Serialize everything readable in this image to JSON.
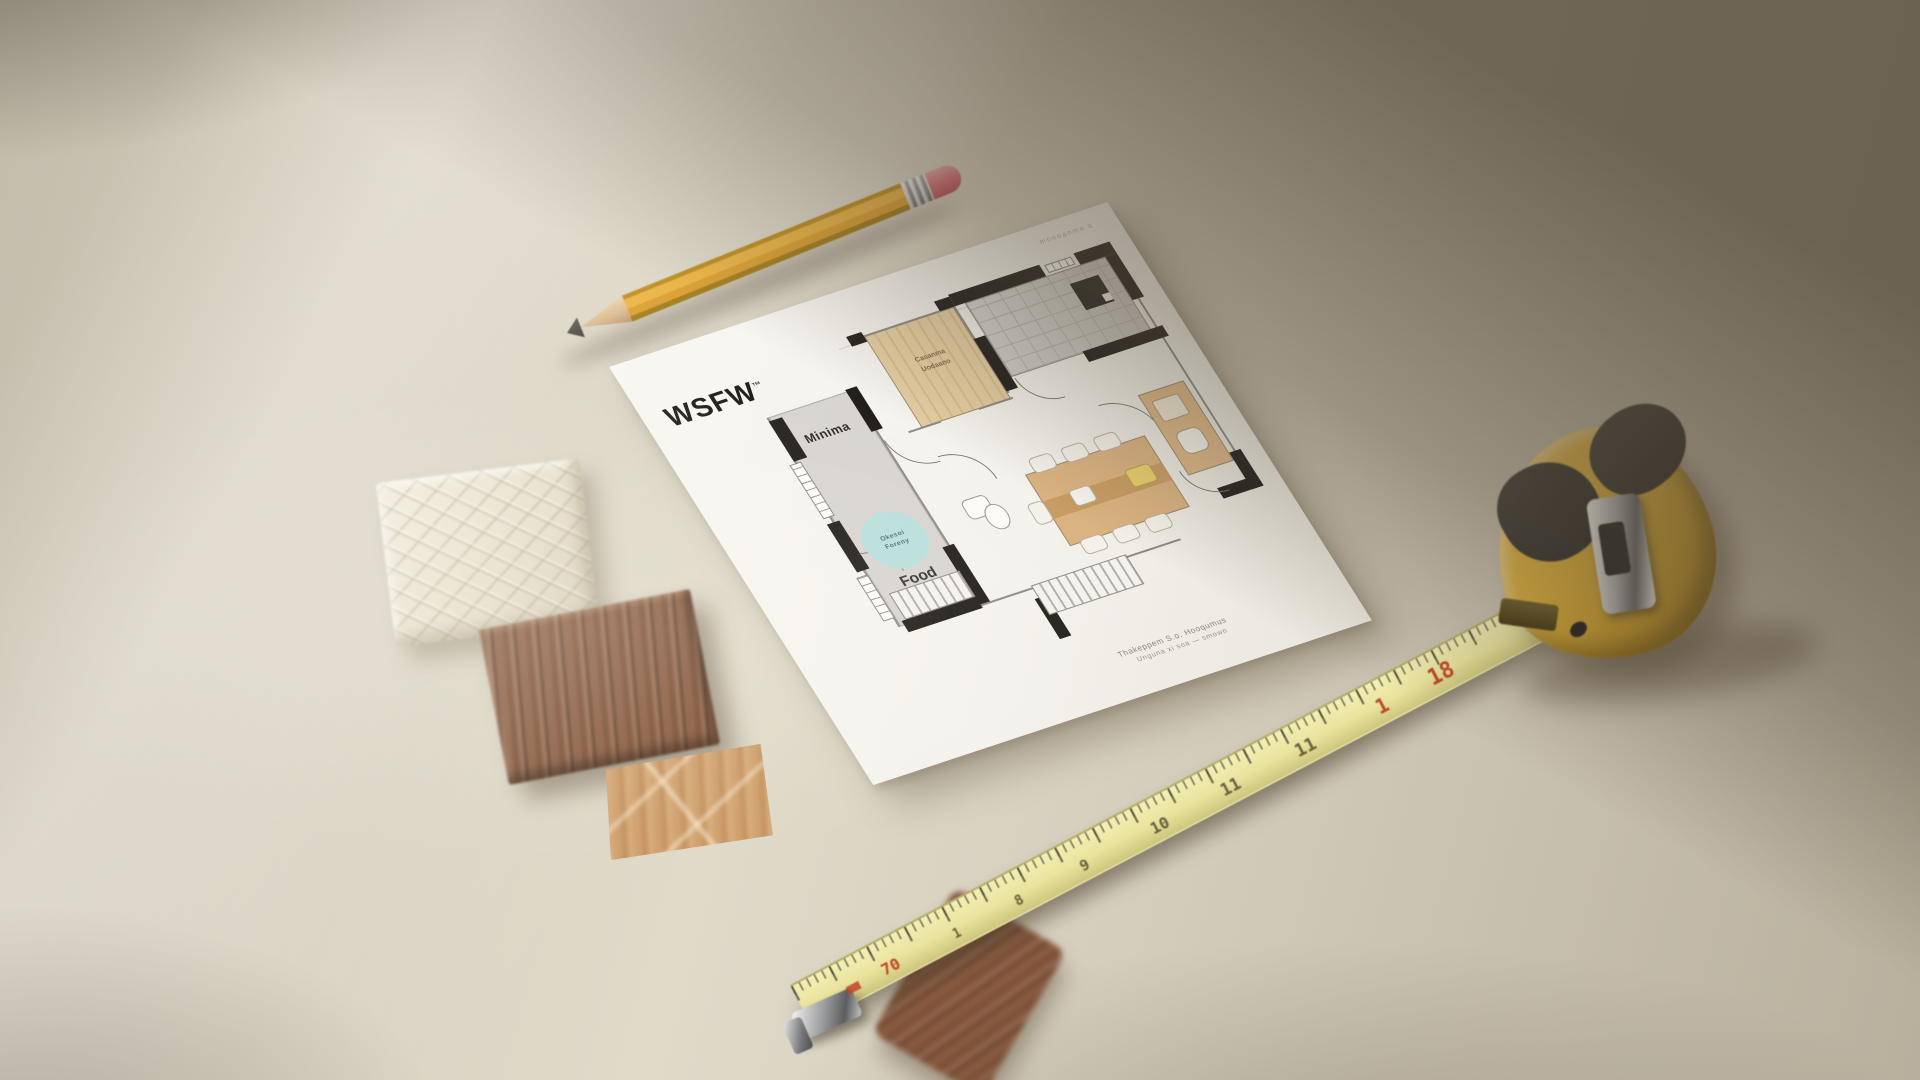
{
  "scene": {
    "description": "Top-down photo of an architectural floor-plan sheet on a warm beige desk with a yellow pencil, yellow tape measure, ceramic tile and wood material samples",
    "colors": {
      "desk": "#d6cfbf",
      "corner_shadow": "#564a3a",
      "paper": "#f6f4ee",
      "pencil_body": "#eaaf38",
      "pencil_eraser": "#d9666f",
      "tape_blade": "#e9e39d",
      "tape_case": "#d8ab33",
      "tape_red": "#c0452b",
      "plan_wall": "#221f1c",
      "plan_wood_floor": "#e0c79c",
      "plan_grey_floor": "#d8d5d1",
      "zone_circle_teal": "#b9dfdc"
    }
  },
  "paper": {
    "logo": "WSFW",
    "logo_mark": "™",
    "header_note": "monoanma a",
    "fine_print_line1": "Thakeppem S.o.  Hooqumus",
    "fine_print_line2": "Unguna  xi  soa  —  smown"
  },
  "floor_plan": {
    "room_left_label": "Minima",
    "room_wood_label1": "Casanma",
    "room_wood_label2": "Uodaano",
    "zone_circle_line1": "Okesoi",
    "zone_circle_line2": "Foreny",
    "zone_label": "Food"
  },
  "tape_measure": {
    "numbers": [
      {
        "value": "70",
        "red": true
      },
      {
        "value": "1",
        "red": false
      },
      {
        "value": "8",
        "red": false
      },
      {
        "value": "9",
        "red": false
      },
      {
        "value": "10",
        "red": false
      },
      {
        "value": "11",
        "red": false
      },
      {
        "value": "11",
        "red": false
      },
      {
        "value": "1",
        "red": true
      },
      {
        "value": "18",
        "red": true
      }
    ]
  }
}
